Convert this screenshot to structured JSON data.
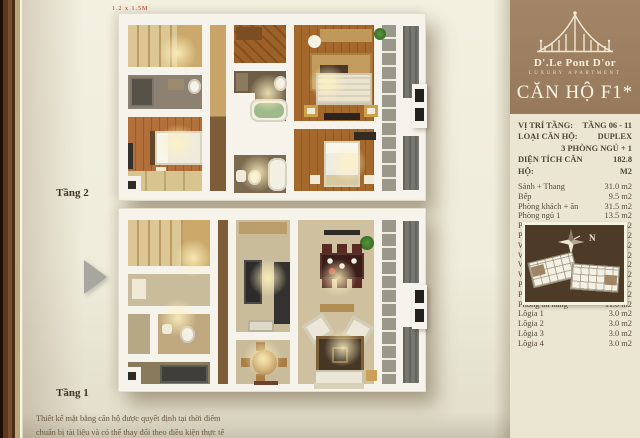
{
  "page": {
    "floor2_label": "Tầng 2",
    "floor1_label": "Tầng 1",
    "dimension_note": "1.2 x 1.5M",
    "caption_line1": "Thiết kế mặt bằng căn hộ được quyết định tại thời điểm",
    "caption_line2": "chuẩn bị tài liệu và có thể thay đổi theo điều kiện thực tế"
  },
  "sidebar": {
    "brand": "D'.Le Pont D'or",
    "brand_sub": "LUXURY APARTMENT",
    "unit_title": "CĂN HỘ F1*",
    "colors": {
      "header_brown": "#9d8164",
      "panel_cream": "#eae6d2",
      "siteplan_brown": "#4e3b27",
      "page_cream": "#efecdb"
    },
    "specs": [
      {
        "label": "VỊ TRÍ TẦNG:",
        "value": "TẦNG 06 - 11"
      },
      {
        "label": "LOẠI CĂN HỘ:",
        "value": "DUPLEX"
      },
      {
        "label": "",
        "value": "3 PHÒNG NGỦ + 1"
      },
      {
        "label": "DIỆN TÍCH CĂN HỘ:",
        "value": "182.8 M2"
      }
    ],
    "areas": [
      {
        "label": "Sảnh + Thang",
        "value": "31.0 m2"
      },
      {
        "label": "Bếp",
        "value": "9.5 m2"
      },
      {
        "label": "Phòng khách + ăn",
        "value": "31.5 m2"
      },
      {
        "label": "Phòng ngủ 1",
        "value": "13.5 m2"
      },
      {
        "label": "Phòng ngủ 2",
        "value": "18.0 m2"
      },
      {
        "label": "Phòng ngủ Master",
        "value": "23.0 m2"
      },
      {
        "label": "WC Master",
        "value": "8.0 m2"
      },
      {
        "label": "WC 1",
        "value": "5.5 m2"
      },
      {
        "label": "WC 2",
        "value": "6.0 m2"
      },
      {
        "label": "WC 3",
        "value": "4.0 m2"
      },
      {
        "label": "Phòng giặt",
        "value": "4.5 m2"
      },
      {
        "label": "Phòng giúp việc",
        "value": "6.1 m2"
      },
      {
        "label": "Phòng đa năng",
        "value": "11.0 m2"
      },
      {
        "label": "Lôgia 1",
        "value": "3.0 m2"
      },
      {
        "label": "Lôgia 2",
        "value": "3.0 m2"
      },
      {
        "label": "Lôgia 3",
        "value": "3.0 m2"
      },
      {
        "label": "Lôgia 4",
        "value": "3.0 m2"
      }
    ],
    "siteplan": {
      "north_label": "N"
    }
  }
}
